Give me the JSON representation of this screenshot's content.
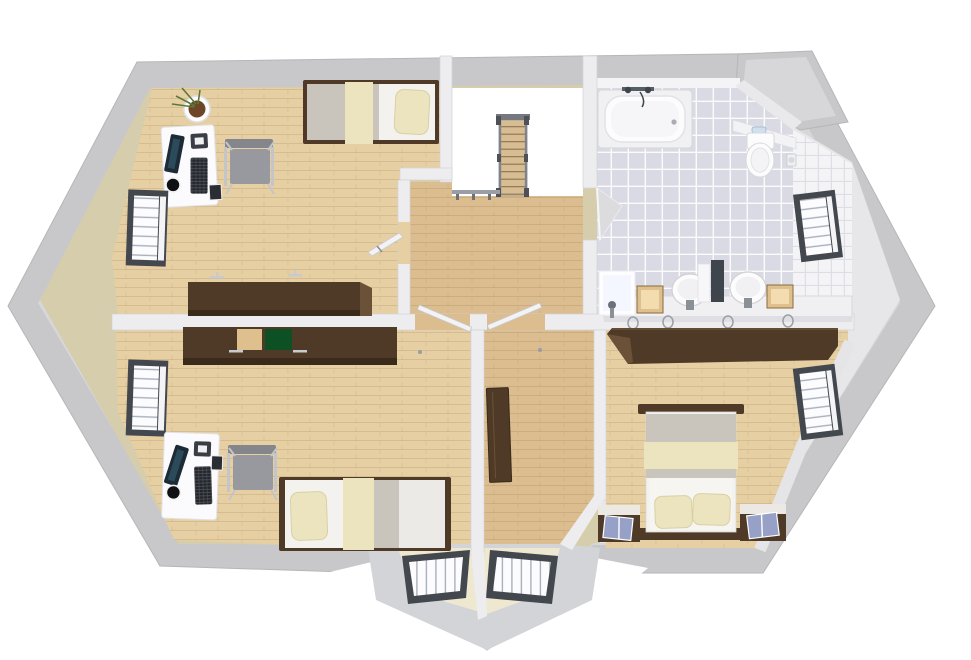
{
  "scene": {
    "view": "top-down-3d-floor-plan-render",
    "background_color": "#ffffff"
  },
  "colors": {
    "background": "#ffffff",
    "roof_mid": "#c8c8ca",
    "roof_light": "#d7d7d9",
    "roof_edge": "#b6b6b9",
    "wall_white": "#ededef",
    "wall_beige": "#d6cdac",
    "neutral_wall": "#e7e7ea",
    "wood_floor": "#e7cfa4",
    "wood_floor_hall": "#dcbd90",
    "wood_dark": "#4e3a26",
    "wood_dark_face": "#6b5138",
    "tile_floor": "#d9dae3",
    "tile_wall": "#f4f4f7",
    "fixture_white": "#fcfcfd",
    "blanket_gray": "#c9c5bd",
    "cream": "#ece4bf",
    "mattress_white": "#f3f2ef",
    "green_door": "#0d5024",
    "tan_door": "#ddc08d",
    "window_frame": "#43474e",
    "chair_gray": "#97999e",
    "metal": "#c3c5c9",
    "stair_rail": "#80838a",
    "book_blue": "#97a0c6",
    "screen_dark": "#1c2b36",
    "plant_green": "#5a7a3a",
    "soil": "#6d4628",
    "bay_ledge": "#efe8d0",
    "door_leaf": "#f3f3f5"
  },
  "rooms": [
    {
      "id": "bedroom-study-top-left",
      "floor": "light wood planks"
    },
    {
      "id": "stair-landing",
      "floor": "wood planks"
    },
    {
      "id": "stairwell-void",
      "floor": "open white void"
    },
    {
      "id": "bathroom",
      "floor": "gray tile grid"
    },
    {
      "id": "bedroom-study-bottom-left",
      "floor": "light wood planks"
    },
    {
      "id": "hallway",
      "floor": "wood planks"
    },
    {
      "id": "master-bedroom",
      "floor": "light wood planks"
    }
  ],
  "objects": {
    "bedroom_study_top_left": [
      "potted-plant",
      "white-desk",
      "computer-monitor",
      "keyboard",
      "mug",
      "office-chair",
      "single-bed-gray-cream",
      "dark-dresser",
      "wall-lamps",
      "window-left-upper",
      "open-door"
    ],
    "stair_area": [
      "staircase-flight",
      "stair-railing",
      "landing-railing"
    ],
    "bathroom": [
      "bathtub-with-faucet",
      "wall-toilet",
      "toilet-paper-holder",
      "double-sink-vanity",
      "round-sink-left",
      "round-sink-right",
      "mirror-panel",
      "tan-cabinet-left",
      "tan-cabinet-right",
      "lit-panel",
      "towel-rings",
      "window-right-bath",
      "open-door-wedge"
    ],
    "bedroom_study_bottom_left": [
      "sideboard-green-tan-doors",
      "white-desk",
      "computer-monitor",
      "keyboard",
      "mug",
      "office-chair",
      "single-bed-cream",
      "wall-lamps",
      "window-left-lower"
    ],
    "hallway": [
      "open-door-leaf-left",
      "open-door-leaf-right",
      "dark-open-door",
      "bay-window-left",
      "bay-window-right"
    ],
    "master_bedroom": [
      "long-wardrobe",
      "double-bed",
      "pillow-left",
      "pillow-right",
      "nightstand-left-with-book",
      "nightstand-right-with-book",
      "window-right-master"
    ]
  }
}
